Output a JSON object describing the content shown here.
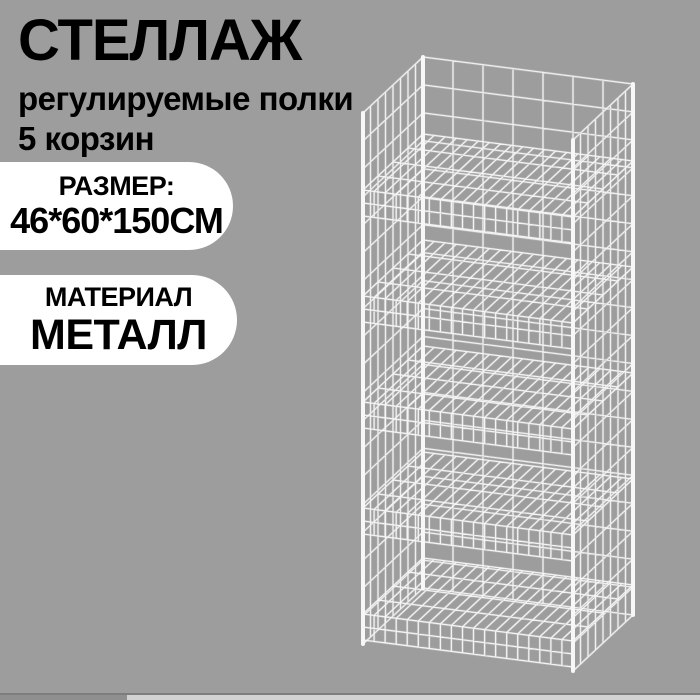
{
  "theme": {
    "background": "#9d9d9d",
    "text_color": "#000000",
    "badge_background": "#ffffff",
    "wire_color": "#f7f7f7"
  },
  "headline": {
    "title": "СТЕЛЛАЖ",
    "line1": "регулируемые полки",
    "line2": "5 корзин"
  },
  "badges": [
    {
      "label": "РАЗМЕР:",
      "value": "46*60*150СМ"
    },
    {
      "label": "МАТЕРИАЛ",
      "value": "МЕТАЛЛ"
    }
  ],
  "illustration": {
    "name": "wire-mesh-rack-with-baskets",
    "basket_count": 5
  }
}
